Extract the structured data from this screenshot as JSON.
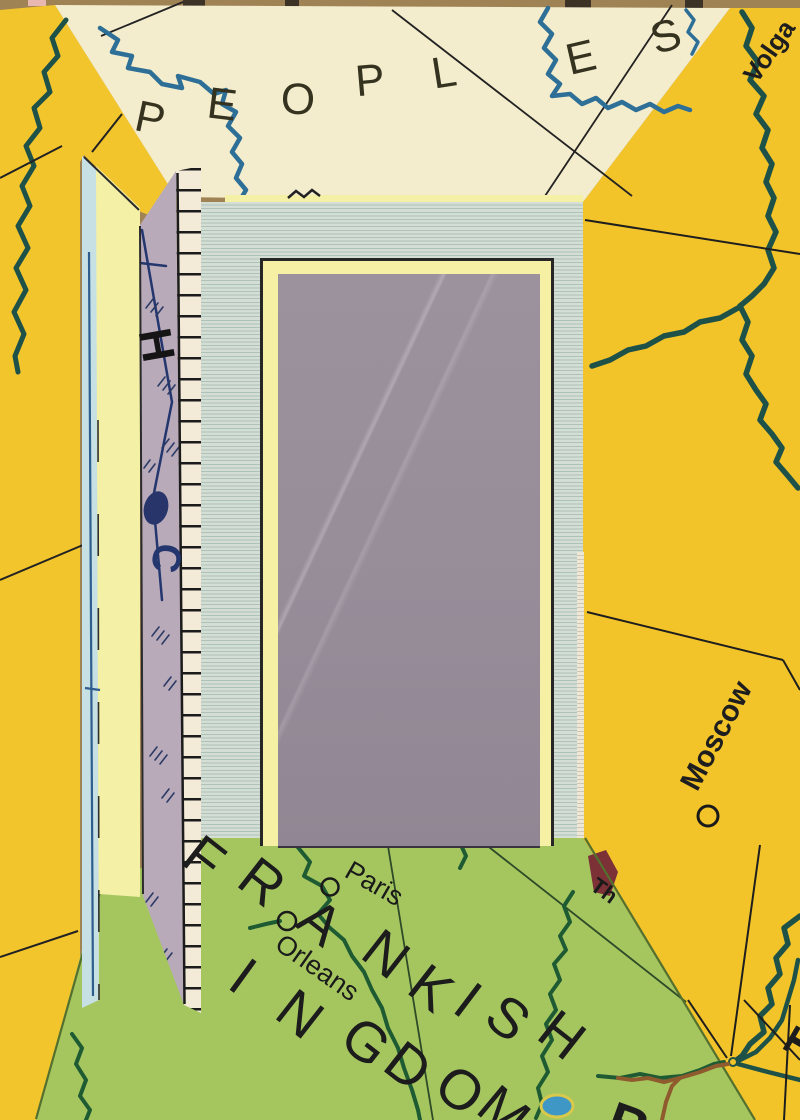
{
  "artwork_kind": "paper map collage of a room with an open door",
  "colors": {
    "table_edge": "#A08355",
    "wall_yellow": "#F3C52D",
    "ceiling_cream": "#F3EDCD",
    "floor_green": "#A5C65F",
    "door_wall_paper": "#D5DED4",
    "frame_yellow": "#F5F0A3",
    "panel_purple": "#9C929E",
    "open_door_purple": "#B9AABA",
    "ruler_strip": "#F3EAD7",
    "jamb_blue": "#C6E0E4",
    "jamb_pale_yellow": "#F4F0A5",
    "river_teal": "#1E5148",
    "river_ceiling_blue": "#2E6F97",
    "river_floor_green": "#1E5B33",
    "river_brown": "#8F5B2E",
    "lake_blue": "#3F97C6",
    "ink_black": "#1E1E1E",
    "door_pattern_navy": "#23366E"
  },
  "letter_groups": [
    {
      "name": "ceiling-text-peoples",
      "color": "#35321F",
      "size": 44,
      "weight": 400,
      "items": [
        {
          "t": "P",
          "x": 150,
          "y": 119,
          "r": 12
        },
        {
          "t": "E",
          "x": 222,
          "y": 105,
          "r": 7
        },
        {
          "t": "O",
          "x": 298,
          "y": 100,
          "r": 2
        },
        {
          "t": "P",
          "x": 370,
          "y": 81,
          "r": -5
        },
        {
          "t": "L",
          "x": 444,
          "y": 73,
          "r": -9
        },
        {
          "t": "E",
          "x": 581,
          "y": 58,
          "r": -13
        },
        {
          "t": "S",
          "x": 666,
          "y": 37,
          "r": -17
        }
      ]
    },
    {
      "name": "wall-label-volga",
      "color": "#1E1E1E",
      "size": 26,
      "weight": 700,
      "items": [
        {
          "t": "Volga",
          "x": 769,
          "y": 51,
          "r": -55
        }
      ]
    },
    {
      "name": "wall-label-moscow",
      "color": "#1E1E1E",
      "size": 30,
      "weight": 700,
      "items": [
        {
          "t": "Moscow",
          "x": 717,
          "y": 736,
          "r": -62
        }
      ]
    },
    {
      "name": "floor-text-frankish",
      "color": "#1C1C1C",
      "size": 56,
      "weight": 400,
      "items": [
        {
          "t": "F",
          "x": 204,
          "y": 858,
          "r": 38
        },
        {
          "t": "R",
          "x": 262,
          "y": 882,
          "r": 38
        },
        {
          "t": "A",
          "x": 320,
          "y": 922,
          "r": 38
        },
        {
          "t": "N",
          "x": 386,
          "y": 954,
          "r": 38
        },
        {
          "t": "K",
          "x": 431,
          "y": 988,
          "r": 38
        },
        {
          "t": "I",
          "x": 468,
          "y": 1000,
          "r": 37
        },
        {
          "t": "S",
          "x": 508,
          "y": 1018,
          "r": 38
        },
        {
          "t": "H",
          "x": 562,
          "y": 1035,
          "r": 38
        }
      ]
    },
    {
      "name": "floor-text-ingdom",
      "color": "#1C1C1C",
      "size": 56,
      "weight": 400,
      "items": [
        {
          "t": "I",
          "x": 243,
          "y": 976,
          "r": 36
        },
        {
          "t": "N",
          "x": 300,
          "y": 1014,
          "r": 38
        },
        {
          "t": "G",
          "x": 366,
          "y": 1042,
          "r": 38
        },
        {
          "t": "D",
          "x": 408,
          "y": 1066,
          "r": 38
        },
        {
          "t": "O",
          "x": 460,
          "y": 1090,
          "r": 38
        },
        {
          "t": "M",
          "x": 504,
          "y": 1112,
          "r": 40
        },
        {
          "t": "B",
          "x": 628,
          "y": 1126,
          "r": 20,
          "w": 700
        },
        {
          "t": "T",
          "x": 803,
          "y": 1045,
          "r": -60,
          "w": 700,
          "s": 46
        }
      ]
    },
    {
      "name": "floor-label-paris",
      "color": "#1A1A1A",
      "size": 27,
      "weight": 400,
      "items": [
        {
          "t": "Paris",
          "x": 374,
          "y": 884,
          "r": 30
        }
      ]
    },
    {
      "name": "floor-label-orleans",
      "color": "#1A1A1A",
      "size": 27,
      "weight": 400,
      "items": [
        {
          "t": "Orleans",
          "x": 317,
          "y": 968,
          "r": 35
        }
      ]
    },
    {
      "name": "floor-label-th",
      "color": "#1A1A1A",
      "size": 22,
      "weight": 700,
      "items": [
        {
          "t": "Th",
          "x": 604,
          "y": 891,
          "r": 36
        }
      ]
    },
    {
      "name": "door-glyphs",
      "color": "#151515",
      "size": 46,
      "weight": 700,
      "items": [
        {
          "t": "H",
          "x": 157,
          "y": 345,
          "r": 80
        },
        {
          "t": "C",
          "x": 166,
          "y": 558,
          "r": 100,
          "c": "#23366E",
          "s": 40
        }
      ]
    }
  ]
}
